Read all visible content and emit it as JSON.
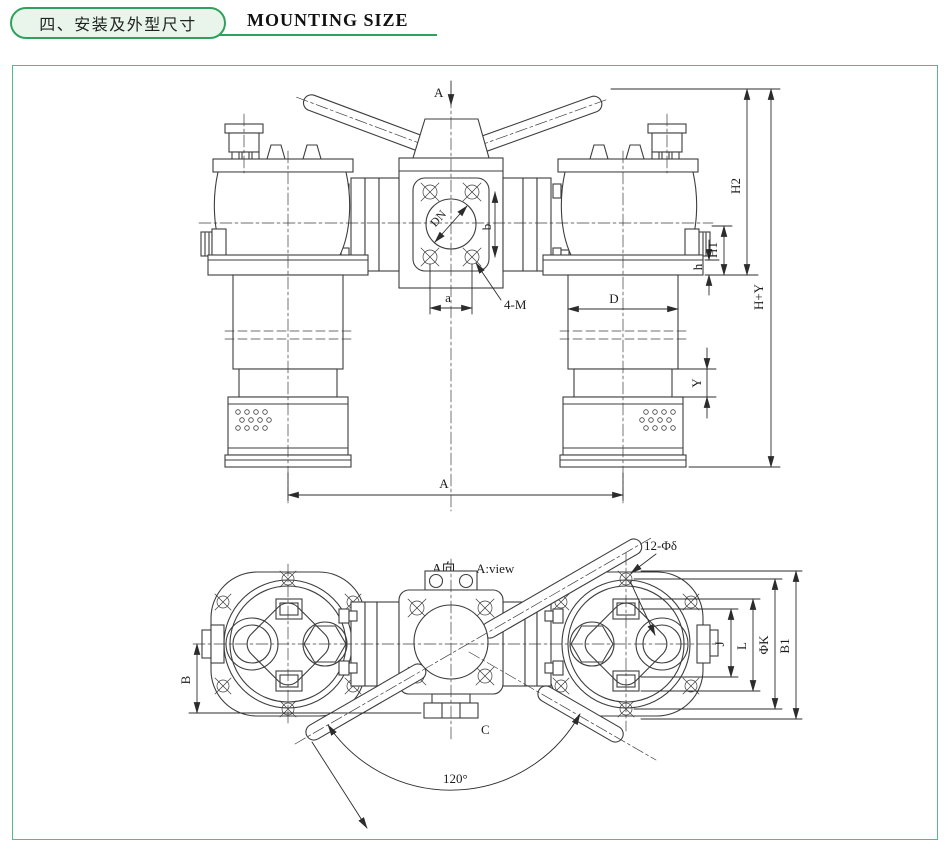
{
  "header": {
    "section_no_title": "四、安装及外型尺寸",
    "title_en": "MOUNTING SIZE"
  },
  "front_view": {
    "view_arrow": "A",
    "nominal_bore": "DN",
    "port_span_v": "b",
    "bolt_thread": "4-M",
    "bolt_span": "a",
    "bowl_diameter": "D",
    "clearance_y": "Y",
    "flange_thickness": "h",
    "height_h1": "H1",
    "height_h2": "H2",
    "overall_height": "H+Y",
    "center_distance": "A"
  },
  "plan_view": {
    "title_cn": "A向",
    "title_en": "A:view",
    "bolt_holes": "12-Φδ",
    "dim_b": "B",
    "dim_c": "C",
    "swing_angle": "120°",
    "dim_j": "J",
    "dim_l": "L",
    "bolt_circle": "ΦK",
    "dim_b1": "B1"
  },
  "colors": {
    "accent": "#2ea25c",
    "pill_bg": "#e9f5ea",
    "line": "#3d3d3d"
  }
}
